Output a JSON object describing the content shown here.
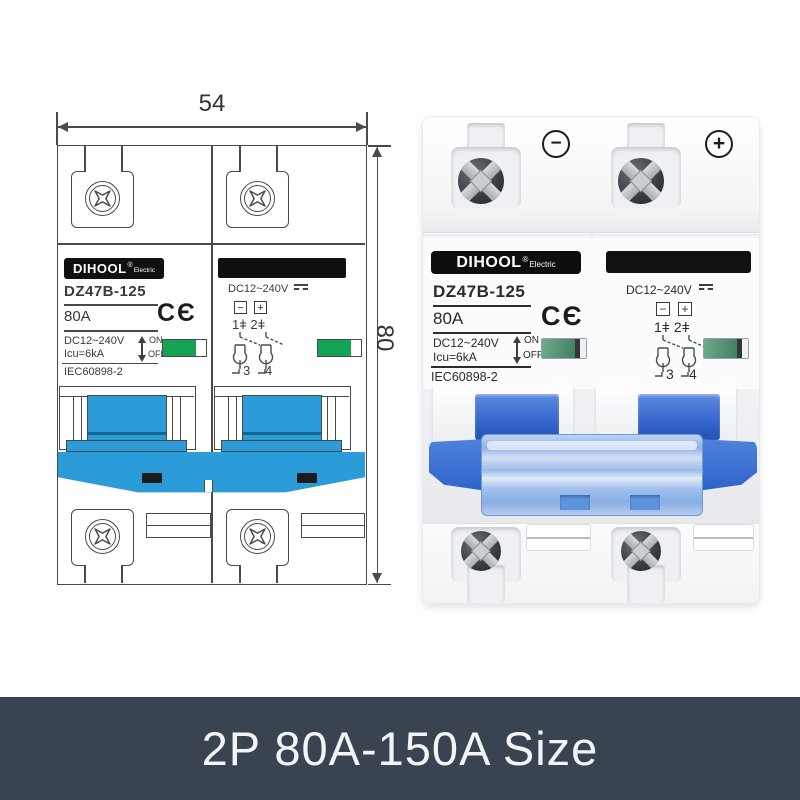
{
  "caption": {
    "text": "2P 80A-150A Size",
    "bar_color": "#3a4350",
    "text_color": "#f3f4f6"
  },
  "dimensions": {
    "width_mm": "54",
    "height_mm": "80"
  },
  "device": {
    "brand": "DIHOOL",
    "brand_reg": "®",
    "brand_sub": "Electric",
    "model": "DZ47B-125",
    "rating": "80A",
    "ce_mark": "CЄ",
    "voltage": "DC12~240V",
    "breaking_capacity": "Icu=6kA",
    "on_label": "ON",
    "off_label": "OFF",
    "standard": "IEC60898-2",
    "dc_voltage": "DC12~240V",
    "minus": "−",
    "plus": "+",
    "terminals_top": "1ǂ 2ǂ",
    "terminal_3": "3",
    "terminal_4": "4",
    "polarity_minus": "−",
    "polarity_plus": "+"
  },
  "colors": {
    "drawing_line": "#4a4a4a",
    "drawing_blue": "#2b9cd8",
    "drawing_green": "#15a356",
    "photo_handle_blue": "#3566ce",
    "photo_bar_blue": "#a9c6ee",
    "label_black": "#101012"
  }
}
